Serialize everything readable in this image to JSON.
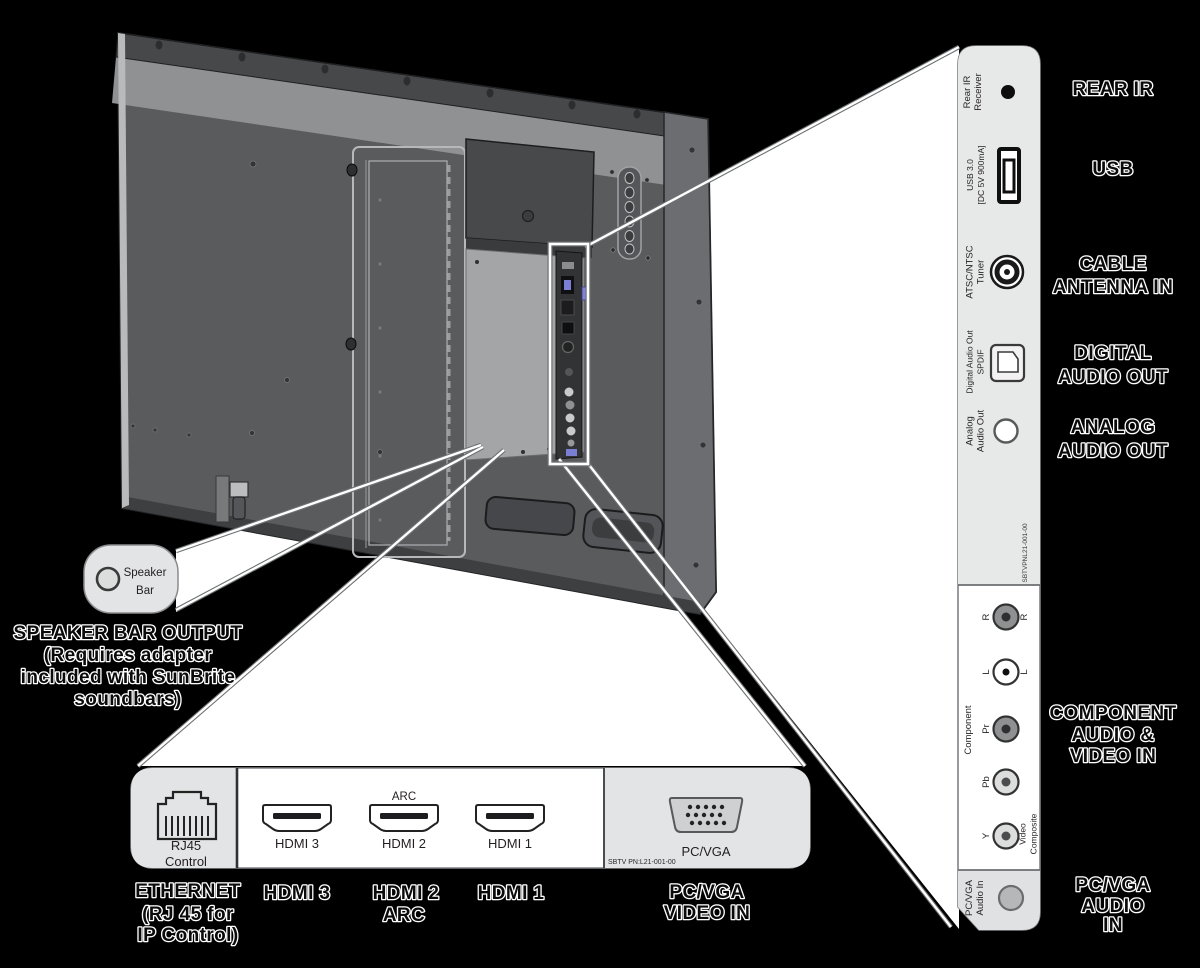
{
  "colors": {
    "background": "#000000",
    "tv_back": "#5a5b5d",
    "tv_rail": "#47484a",
    "tv_bevel": "#8f9193",
    "tv_side": "#6b6d70",
    "panel_light": "#e6e7e8",
    "panel_white": "#ffffff",
    "usb_accent": "#7b7fd4"
  },
  "speaker_callout": {
    "port_label": [
      "Speaker",
      "Bar"
    ],
    "caption": [
      "SPEAKER BAR OUTPUT",
      "(Requires adapter",
      "included with SunBrite",
      "soundbars)"
    ]
  },
  "side_panel": {
    "serial": "SBTVPNL21-001-00",
    "ports": {
      "rear_ir": [
        "Rear IR",
        "Receiver"
      ],
      "usb": [
        "USB 3.0",
        "[DC 5V 900mA]"
      ],
      "tuner": [
        "ATSC/NTSC",
        "Tuner"
      ],
      "digital_audio": [
        "Digital Audio Out",
        "SPDIF"
      ],
      "analog_audio": [
        "Analog",
        "Audio Out"
      ],
      "component": "Component",
      "r": "R",
      "l": "L",
      "pr": "Pr",
      "pb": "Pb",
      "y": "Y",
      "video_composite": [
        "Video",
        "Composite"
      ],
      "pc_vga_audio": [
        "PC/VGA",
        "Audio In"
      ]
    }
  },
  "side_labels": {
    "rear_ir": [
      "REAR IR"
    ],
    "usb": [
      "USB"
    ],
    "cable_antenna": [
      "CABLE",
      "ANTENNA IN"
    ],
    "digital_audio": [
      "DIGITAL",
      "AUDIO OUT"
    ],
    "analog_audio": [
      "ANALOG",
      "AUDIO OUT"
    ],
    "component": [
      "COMPONENT",
      "AUDIO &",
      "VIDEO IN"
    ],
    "pc_vga_audio": [
      "PC/VGA",
      "AUDIO",
      "IN"
    ]
  },
  "bottom_panel": {
    "serial": "SBTV PN:L21-001-00",
    "rj45": [
      "RJ45",
      "Control"
    ],
    "arc": "ARC",
    "hdmi3": "HDMI 3",
    "hdmi2": "HDMI 2",
    "hdmi1": "HDMI 1",
    "pc_vga": "PC/VGA"
  },
  "bottom_labels": {
    "ethernet": [
      "ETHERNET",
      "(RJ 45 for",
      "IP Control)"
    ],
    "hdmi3": [
      "HDMI 3"
    ],
    "hdmi2": [
      "HDMI 2",
      "ARC"
    ],
    "hdmi1": [
      "HDMI 1"
    ],
    "pc_vga": [
      "PC/VGA",
      "VIDEO IN"
    ]
  }
}
